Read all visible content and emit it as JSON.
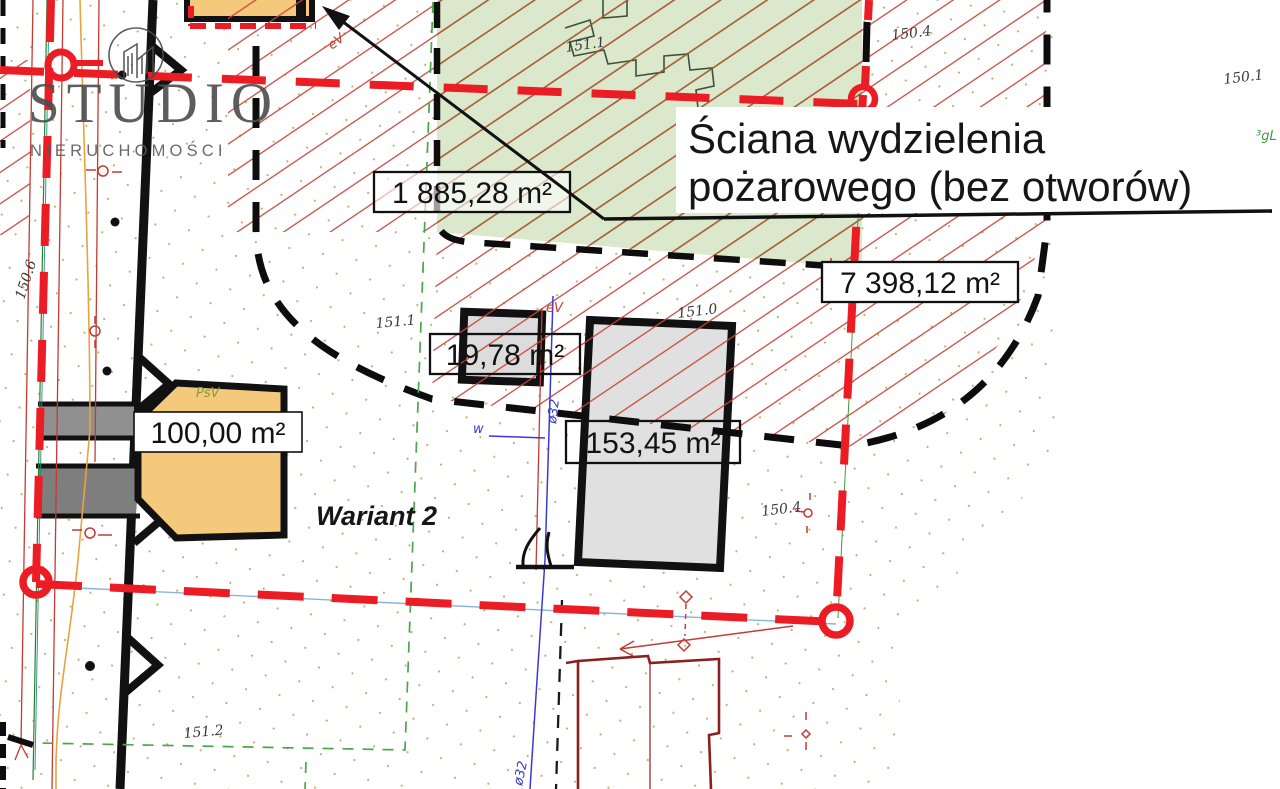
{
  "plan": {
    "variant_label": "Wariant 2",
    "annotation": {
      "line1": "Ściana wydzielenia",
      "line2": "pożarowego (bez otworów)"
    },
    "area_labels": {
      "green_building": "1 885,28 m²",
      "parcel": "7 398,12 m²",
      "small_building": "19,78 m²",
      "orange_building": "100,00 m²",
      "gray_building": "153,45 m²"
    },
    "elevation_marks": {
      "left_edge": "150.6",
      "bottom_left": "151.2",
      "green_zone": "151.1",
      "near_small_building": "151.1",
      "near_gray_building": "151.0",
      "top_right": "150.4",
      "far_right": "150.1",
      "mid_right": "150.4"
    },
    "utility_labels": {
      "water_line": "w",
      "water_pipe_upper": "ø32",
      "water_pipe_lower": "ø32",
      "power_line_top": "eV",
      "power_line_mid": "eV",
      "land_use": "PsV",
      "gas_mark": "³gL"
    }
  },
  "logo": {
    "title": "STUDIO",
    "subtitle": "NIERUCHOMOŚCI"
  },
  "colors": {
    "boundary_red": "#ec1c24",
    "hatch_red": "#c4453a",
    "hatch_brown": "#9c4a28",
    "green_zone_fill": "#dbe8cc",
    "building_orange": "#f5c97c",
    "building_gray": "#e0e0e0",
    "parcel_green": "#4aa64a",
    "water_blue": "#3a3ad0",
    "existing_building_maroon": "#8b1f1f",
    "road_black": "#111111"
  }
}
